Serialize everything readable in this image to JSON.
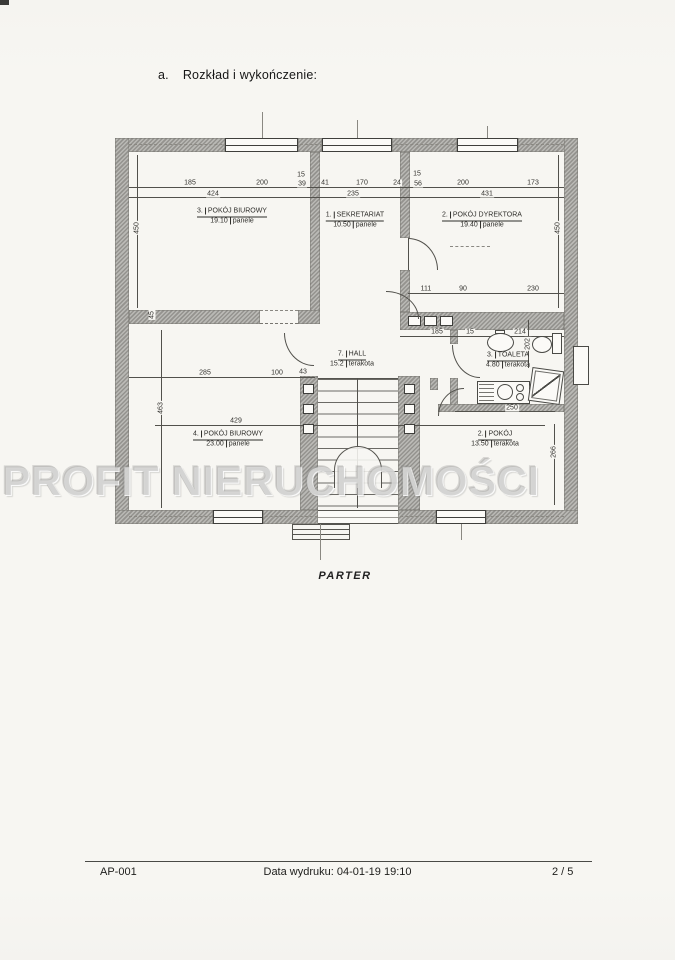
{
  "document": {
    "heading": {
      "index": "a.",
      "text": "Rozkład i wykończenie:"
    },
    "plan_caption": "PARTER",
    "watermark": "PROFIT NIERUCHOMOŚCI",
    "footer": {
      "doc_code": "AP-001",
      "print_info": "Data wydruku: 04-01-19 19:10",
      "page_indicator": "2 / 5"
    }
  },
  "floor_plan": {
    "rooms": [
      {
        "no": "3.",
        "name": "POKÓJ BIUROWY",
        "area": "19.10",
        "finish": "panele"
      },
      {
        "no": "1.",
        "name": "SEKRETARIAT",
        "area": "10.50",
        "finish": "panele"
      },
      {
        "no": "2.",
        "name": "POKÓJ DYREKTORA",
        "area": "19.40",
        "finish": "panele"
      },
      {
        "no": "7.",
        "name": "HALL",
        "area": "15.2",
        "finish": "terakota"
      },
      {
        "no": "3.",
        "name": "TOALETA",
        "area": "4.80",
        "finish": "terakota"
      },
      {
        "no": "4.",
        "name": "POKÓJ BIUROWY",
        "area": "23.00",
        "finish": "panele"
      },
      {
        "no": "2.",
        "name": "POKÓJ",
        "area": "13.50",
        "finish": "terakota"
      }
    ],
    "dims": {
      "top1": [
        "185",
        "200",
        "15",
        "39",
        "41",
        "170",
        "24",
        "15",
        "56",
        "200",
        "173"
      ],
      "top2": [
        "424",
        "235",
        "431"
      ],
      "director_bottom": [
        "111",
        "90",
        "230"
      ],
      "toilet_top": [
        "185",
        "15",
        "214"
      ],
      "hall_row": [
        "285",
        "100",
        "43"
      ],
      "room4_width": "429",
      "toilet_width": "250",
      "v_left_top": "450",
      "v_right_top": "450",
      "v_left_bottom": "463",
      "v_mid_small": "45",
      "v_toilet": "202",
      "v_right_bottom": "266"
    }
  }
}
